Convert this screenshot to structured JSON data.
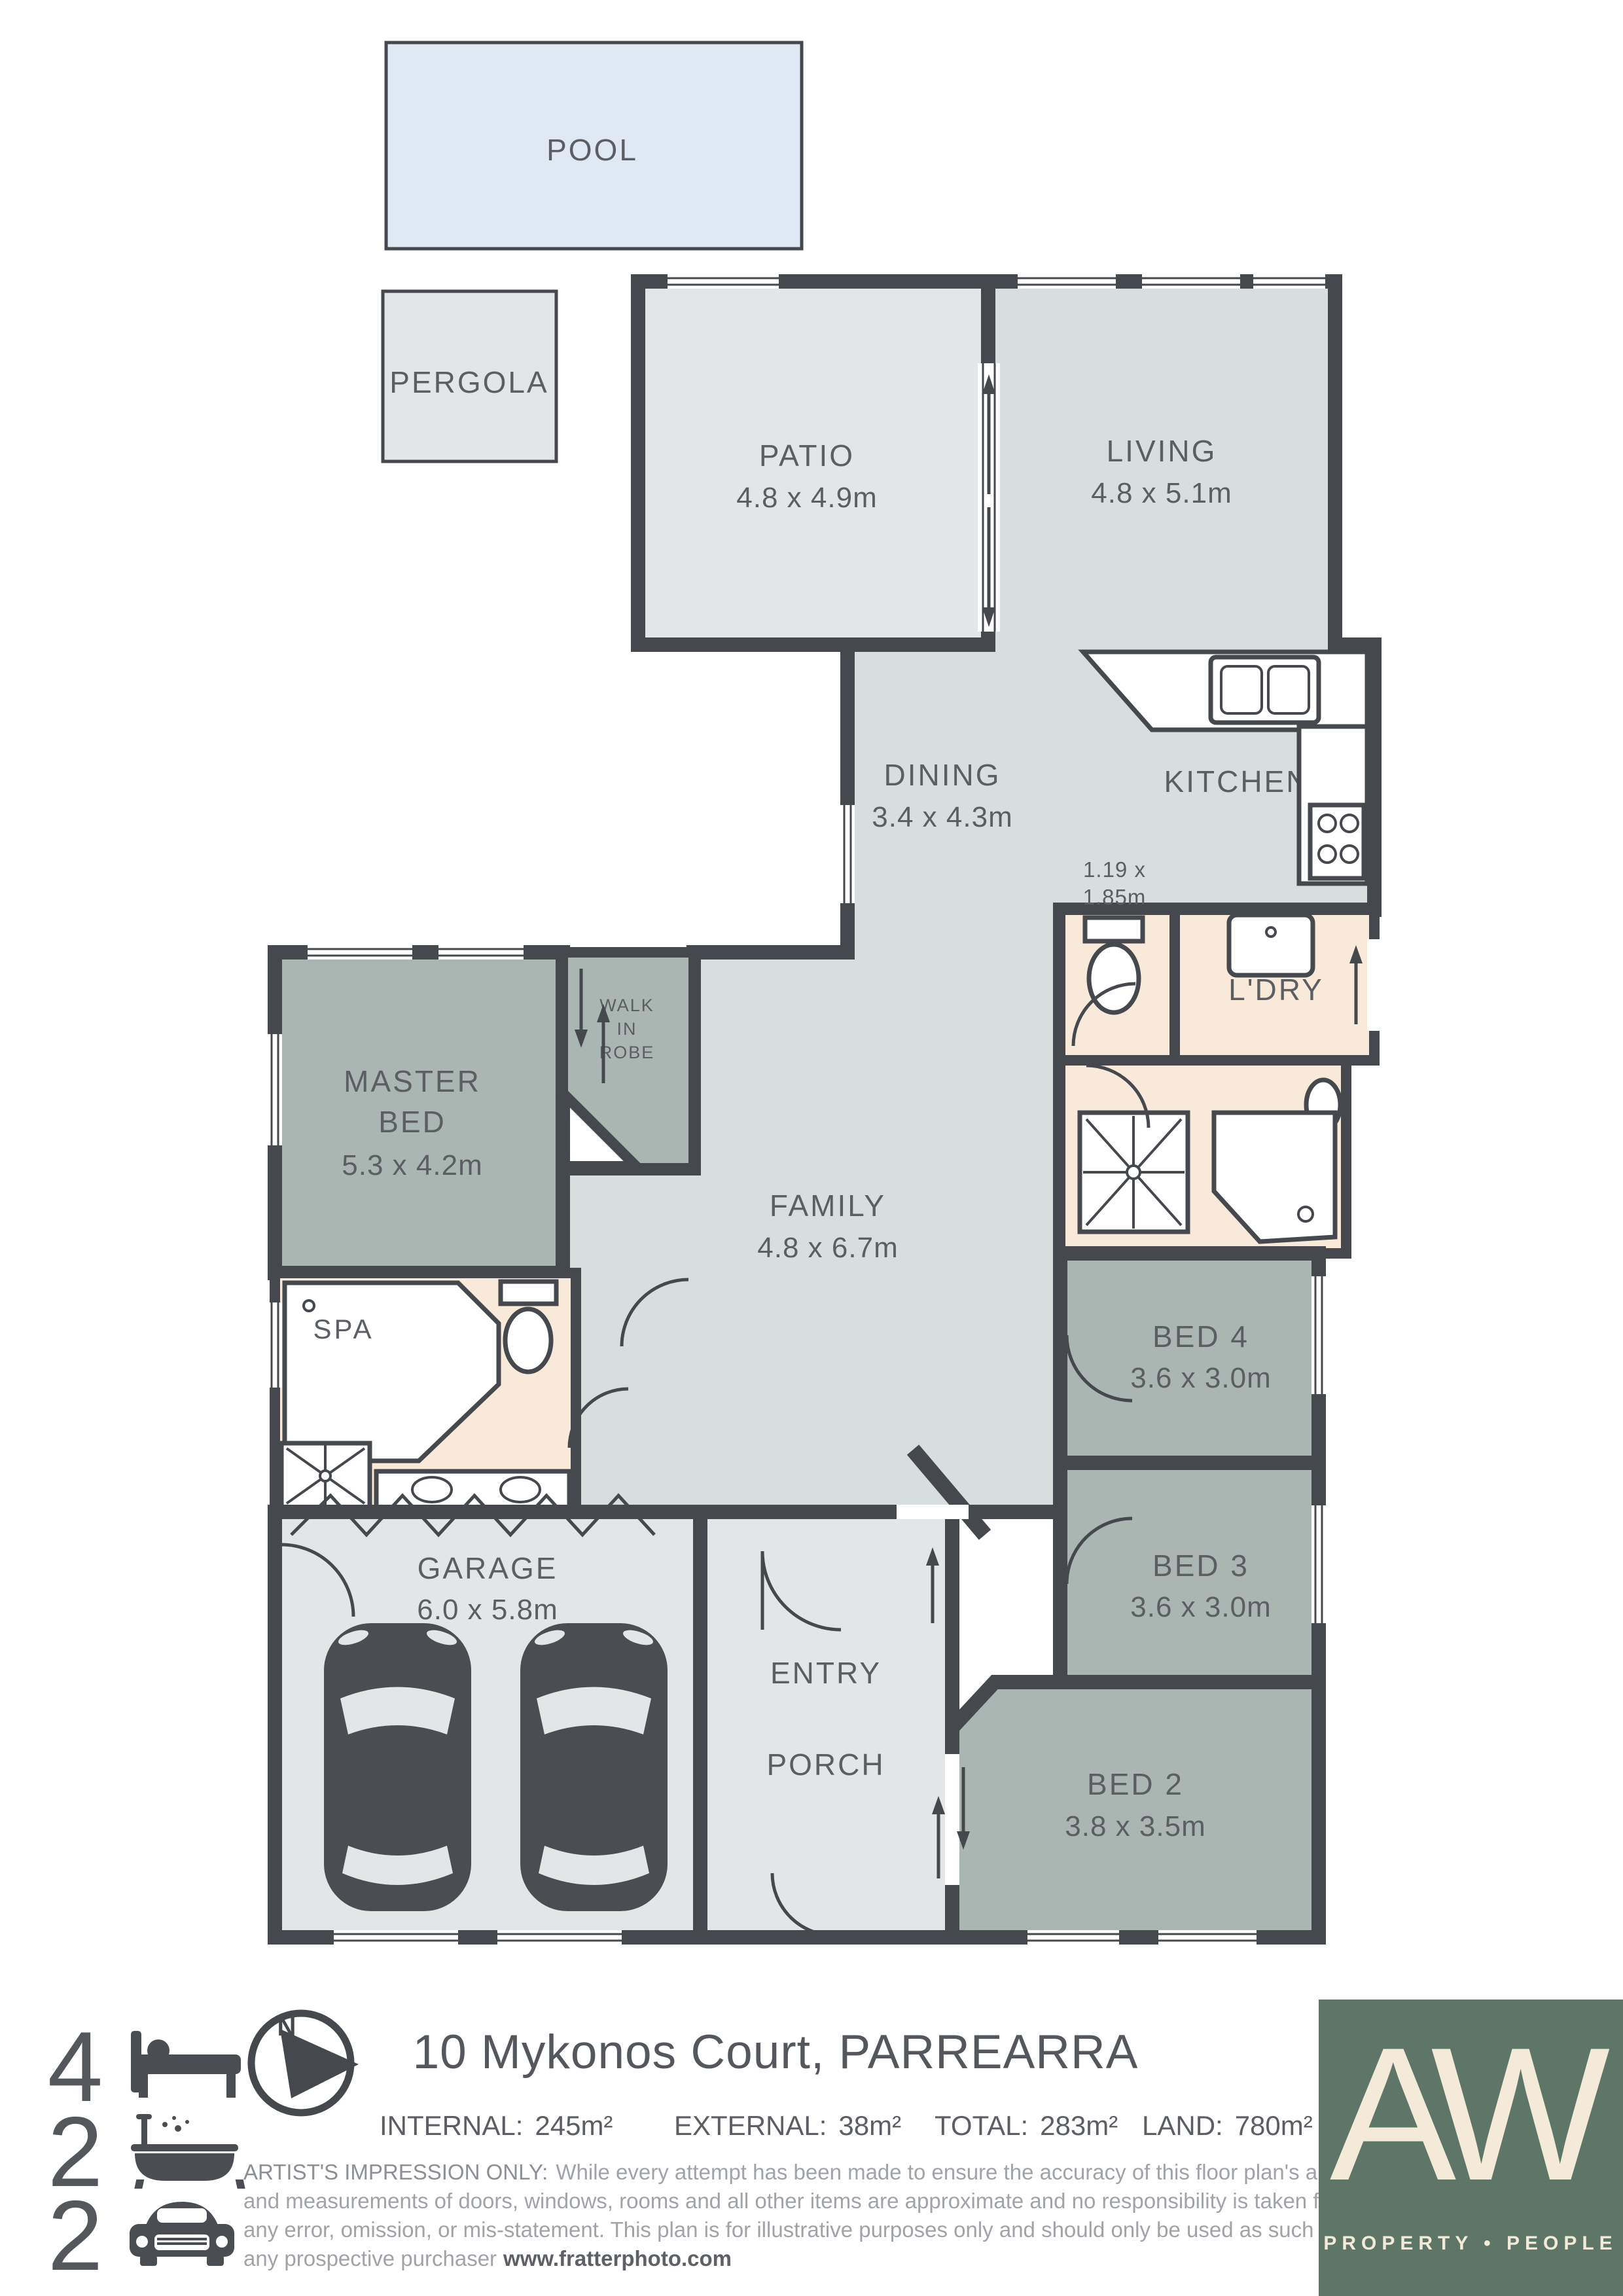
{
  "plan": {
    "pool": "POOL",
    "pergola": "PERGOLA",
    "patio": {
      "name": "PATIO",
      "size": "4.8 x 4.9m"
    },
    "living": {
      "name": "LIVING",
      "size": "4.8 x 5.1m"
    },
    "dining": {
      "name": "DINING",
      "size": "3.4 x 4.3m"
    },
    "kitchen": {
      "name": "KITCHEN"
    },
    "wc": {
      "size_lines": [
        "1.19 x",
        "1.85m"
      ]
    },
    "laundry": {
      "name": "L'DRY"
    },
    "master": {
      "lines": [
        "MASTER",
        "BED"
      ],
      "size": "5.3 x 4.2m"
    },
    "robe": {
      "lines": [
        "WALK",
        "IN",
        "ROBE"
      ]
    },
    "family": {
      "name": "FAMILY",
      "size": "4.8 x 6.7m"
    },
    "spa": {
      "name": "SPA"
    },
    "bed4": {
      "name": "BED 4",
      "size": "3.6 x 3.0m"
    },
    "bed3": {
      "name": "BED 3",
      "size": "3.6 x 3.0m"
    },
    "bed2": {
      "name": "BED 2",
      "size": "3.8 x 3.5m"
    },
    "garage": {
      "name": "GARAGE",
      "size": "6.0 x 5.8m"
    },
    "entry": {
      "name": "ENTRY"
    },
    "porch": {
      "name": "PORCH"
    }
  },
  "footer": {
    "bedrooms": "4",
    "bathrooms": "2",
    "carSpaces": "2",
    "compass_letter": "N",
    "address": "10 Mykonos Court, PARREARRA",
    "stats": [
      {
        "label": "INTERNAL:",
        "value": "245m²"
      },
      {
        "label": "EXTERNAL:",
        "value": "38m²"
      },
      {
        "label": "TOTAL:",
        "value": "283m²"
      },
      {
        "label": "LAND:",
        "value": "780m²"
      }
    ],
    "disclaimer": {
      "heading": "ARTIST'S IMPRESSION ONLY:",
      "line1_rest": "While every attempt has been made to ensure the accuracy of this floor plan's areas",
      "line2": "and measurements of doors, windows, rooms and all other items are approximate and no responsibility is taken for",
      "line3": "any error, omission, or mis-statement. This plan is for illustrative purposes only and should only be used as such by",
      "line4_prefix": "any prospective purchaser",
      "website": "www.fratterphoto.com"
    },
    "logo": {
      "monogram": "AW",
      "tagline": "PROPERTY • PEOPLE"
    }
  },
  "colors": {
    "wall": "#45484d",
    "living_area": "#d8dedd",
    "bedroom": "#a9b6b1",
    "wet_area": "#f8e9d9",
    "outdoor": "#e4e5e6",
    "pool": "#dfe9f4",
    "logo_background": "#5e7668",
    "logo_text": "#f3ead8",
    "label_text": "#5b5e63",
    "disclaimer_text": "#a0a3a7"
  }
}
